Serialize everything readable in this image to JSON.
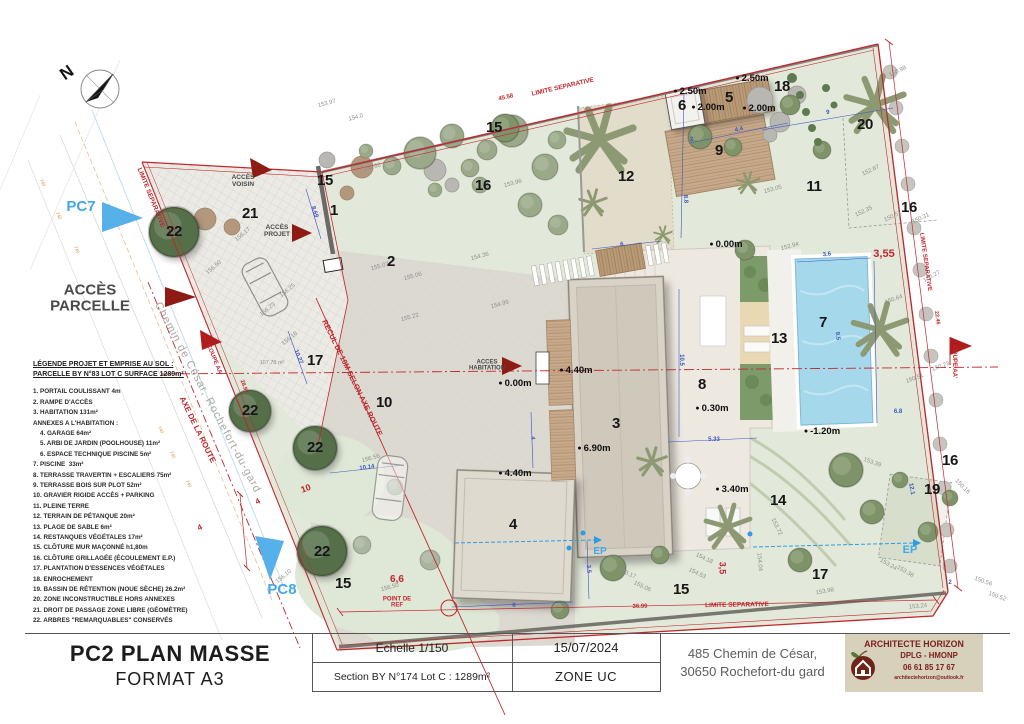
{
  "document": {
    "type_label": "PC2 PLAN MASSE",
    "format_label": "FORMAT A3"
  },
  "title_block": {
    "scale_label": "Echelle  1/150",
    "section_label": "Section BY N°174 Lot C : 1289m²",
    "date": "15/07/2024",
    "zone": "ZONE UC",
    "address_line1": "485 Chemin de César,",
    "address_line2": "30650 Rochefort-du gard",
    "architect": {
      "name": "ARCHITECTE HORIZON",
      "title": "DPLG - HMONP",
      "phone": "06 61 85 17 67",
      "email": "architectehorizon@outlook.fr"
    }
  },
  "legend": {
    "title_line1": "LÉGENDE PROJET ET EMPRISE AU SOL :",
    "title_line2": "PARCELLE BY N°83 LOT C SURFACE 1289m²",
    "items": [
      "1. PORTAIL COULISSANT 4m",
      "2. RAMPE D'ACCÈS",
      "3. HABITATION 131m²",
      "ANNEXES A L'HABITATION :",
      "    4. GARAGE 64m²",
      "    5. ARBI DE JARDIN (POOLHOUSE) 11m²",
      "    6. ESPACE TECHNIQUE PISCINE 5m²",
      "7. PISCINE  33m²",
      "8. TERRASSE TRAVERTIN + ESCALIERS 75m²",
      "9. TERRASSE BOIS SUR PLOT 52m²",
      "10. GRAVIER RIGIDE ACCÈS + PARKING",
      "11. PLEINE TERRE",
      "12. TERRAIN DE PÉTANQUE 20m²",
      "13. PLAGE DE SABLE 6m²",
      "14. RESTANQUES VÉGÉTALES 17m²",
      "15. CLÔTURE MUR MAÇONNÉ h1,80m",
      "16. CLÔTURE GRILLAGÉE (ÉCOULEMENT E.P.)",
      "17. PLANTATION D'ESSENCES VÉGÉTALES",
      "18. ENROCHEMENT",
      "19. BASSIN DE RÉTENTION (NOUE SÈCHE) 26.2m²",
      "20. ZONE INCONSTRUCTIBLE HORS ANNEXES",
      "21. DROIT DE PASSAGE ZONE LIBRE (GÉOMÈTRE)",
      "22. ARBRES \"REMARQUABLES\" CONSERVÉS"
    ]
  },
  "colors": {
    "boundary_red": "#c0272d",
    "dimension_blue": "#3d55c4",
    "marker_blue": "#45a7e8",
    "access_arrow_red": "#8e1b14",
    "pool_blue": "#a6d8ec",
    "logo_bg": "#d7d1bc",
    "logo_text": "#7a2020"
  },
  "plan": {
    "zone_numbers": [
      {
        "t": "22",
        "x": 174,
        "y": 232
      },
      {
        "t": "22",
        "x": 250,
        "y": 411
      },
      {
        "t": "22",
        "x": 315,
        "y": 448
      },
      {
        "t": "22",
        "x": 322,
        "y": 552
      },
      {
        "t": "21",
        "x": 250,
        "y": 214
      },
      {
        "t": "20",
        "x": 865,
        "y": 125
      },
      {
        "t": "18",
        "x": 782,
        "y": 87
      },
      {
        "t": "15",
        "x": 325,
        "y": 181
      },
      {
        "t": "15",
        "x": 494,
        "y": 128
      },
      {
        "t": "15",
        "x": 343,
        "y": 584
      },
      {
        "t": "15",
        "x": 681,
        "y": 590
      },
      {
        "t": "16",
        "x": 483,
        "y": 186
      },
      {
        "t": "16",
        "x": 909,
        "y": 208
      },
      {
        "t": "16",
        "x": 950,
        "y": 461
      },
      {
        "t": "1",
        "x": 334,
        "y": 211
      },
      {
        "t": "2",
        "x": 391,
        "y": 262
      },
      {
        "t": "12",
        "x": 626,
        "y": 177
      },
      {
        "t": "11",
        "x": 814,
        "y": 187
      },
      {
        "t": "5",
        "x": 729,
        "y": 98
      },
      {
        "t": "6",
        "x": 682,
        "y": 106
      },
      {
        "t": "9",
        "x": 719,
        "y": 151
      },
      {
        "t": "10",
        "x": 384,
        "y": 403
      },
      {
        "t": "17",
        "x": 315,
        "y": 361
      },
      {
        "t": "17",
        "x": 820,
        "y": 575
      },
      {
        "t": "3",
        "x": 616,
        "y": 424
      },
      {
        "t": "4",
        "x": 513,
        "y": 525
      },
      {
        "t": "8",
        "x": 702,
        "y": 385
      },
      {
        "t": "7",
        "x": 823,
        "y": 323
      },
      {
        "t": "13",
        "x": 779,
        "y": 339
      },
      {
        "t": "14",
        "x": 778,
        "y": 501
      },
      {
        "t": "19",
        "x": 932,
        "y": 490
      }
    ],
    "level_points": [
      {
        "t": "2.50m",
        "x": 690,
        "y": 92
      },
      {
        "t": "2.50m",
        "x": 752,
        "y": 79
      },
      {
        "t": "2.00m",
        "x": 708,
        "y": 108
      },
      {
        "t": "2.00m",
        "x": 759,
        "y": 109
      },
      {
        "t": "0.00m",
        "x": 726,
        "y": 245
      },
      {
        "t": "0.00m",
        "x": 515,
        "y": 384
      },
      {
        "t": "4.40m",
        "x": 576,
        "y": 371
      },
      {
        "t": "4.40m",
        "x": 515,
        "y": 474
      },
      {
        "t": "6.90m",
        "x": 594,
        "y": 449
      },
      {
        "t": "0.30m",
        "x": 712,
        "y": 409
      },
      {
        "t": "-1.20m",
        "x": 822,
        "y": 432
      },
      {
        "t": "3.40m",
        "x": 732,
        "y": 490
      }
    ],
    "red_labels": [
      {
        "t": "LIMITE SEPARATIVE",
        "x": 563,
        "y": 88,
        "rot": -13
      },
      {
        "t": "45.58",
        "x": 506,
        "y": 98,
        "rot": -13,
        "fs": 6
      },
      {
        "t": "LIMITE SEPARATIVE",
        "x": 150,
        "y": 198,
        "rot": 68
      },
      {
        "t": "LIMITE SEPARATIVE",
        "x": 925,
        "y": 262,
        "rot": 82,
        "fs": 6
      },
      {
        "t": "22.46",
        "x": 936,
        "y": 318,
        "rot": 82,
        "fs": 5.5
      },
      {
        "t": "LIMITE SEPARATIVE",
        "x": 737,
        "y": 606,
        "rot": -1
      },
      {
        "t": "36.99",
        "x": 640,
        "y": 607,
        "rot": -1,
        "fs": 6
      },
      {
        "t": "COUPE AA'",
        "x": 954,
        "y": 362,
        "rot": 90,
        "fs": 6
      },
      {
        "t": "COUPE AA'",
        "x": 214,
        "y": 360,
        "rot": 68,
        "fs": 6
      },
      {
        "t": "28.92",
        "x": 243,
        "y": 387,
        "rot": 68,
        "fs": 5.5
      },
      {
        "t": "AXE DE LA ROUTE",
        "x": 197,
        "y": 430,
        "rot": 64,
        "fs": 8
      },
      {
        "t": "RECUL DE 10M SELON AXE ROUTE",
        "x": 352,
        "y": 378,
        "rot": 64,
        "fs": 7.5
      },
      {
        "t": "POINT DE\nREF",
        "x": 397,
        "y": 603,
        "fs": 6
      },
      {
        "t": "3,55",
        "x": 884,
        "y": 255,
        "fs": 11
      },
      {
        "t": "3,5",
        "x": 722,
        "y": 568,
        "rot": 90,
        "fs": 9
      },
      {
        "t": "6,6",
        "x": 397,
        "y": 580,
        "fs": 10
      },
      {
        "t": "10",
        "x": 306,
        "y": 489,
        "rot": -20,
        "fs": 9
      },
      {
        "t": "4",
        "x": 258,
        "y": 502,
        "rot": -25,
        "fs": 8
      },
      {
        "t": "4",
        "x": 200,
        "y": 528,
        "rot": -25,
        "fs": 8
      }
    ],
    "blue_dims": [
      {
        "t": "4.4",
        "x": 739,
        "y": 130,
        "rot": -12
      },
      {
        "t": "2",
        "x": 692,
        "y": 140,
        "rot": -12
      },
      {
        "t": "9",
        "x": 828,
        "y": 113,
        "rot": -10
      },
      {
        "t": "8.8",
        "x": 685,
        "y": 199,
        "rot": 87
      },
      {
        "t": "6",
        "x": 622,
        "y": 245,
        "rot": -10
      },
      {
        "t": "3.6",
        "x": 827,
        "y": 255,
        "rot": -8
      },
      {
        "t": "9.5",
        "x": 837,
        "y": 336,
        "rot": 85
      },
      {
        "t": "10.5",
        "x": 681,
        "y": 360,
        "rot": 90
      },
      {
        "t": "5.33",
        "x": 714,
        "y": 440
      },
      {
        "t": "4",
        "x": 532,
        "y": 438,
        "rot": 87
      },
      {
        "t": "8",
        "x": 514,
        "y": 606,
        "rot": 3
      },
      {
        "t": "3.5",
        "x": 588,
        "y": 569,
        "rot": 87
      },
      {
        "t": "10.14",
        "x": 367,
        "y": 468,
        "rot": -8
      },
      {
        "t": "10.27",
        "x": 298,
        "y": 357,
        "rot": 68
      },
      {
        "t": "8.69",
        "x": 314,
        "y": 212,
        "rot": 72
      },
      {
        "t": "2",
        "x": 950,
        "y": 583
      },
      {
        "t": "6.8",
        "x": 898,
        "y": 412
      },
      {
        "t": "12.1",
        "x": 911,
        "y": 489,
        "rot": 80
      }
    ],
    "spot_elevations": [
      {
        "t": "153.97",
        "x": 327,
        "y": 104,
        "rot": -15
      },
      {
        "t": "154.0",
        "x": 356,
        "y": 118,
        "rot": -15
      },
      {
        "t": "154.68",
        "x": 372,
        "y": 168,
        "rot": -15
      },
      {
        "t": "153.96",
        "x": 513,
        "y": 184,
        "rot": -15
      },
      {
        "t": "154.36",
        "x": 480,
        "y": 257,
        "rot": -15
      },
      {
        "t": "155.07",
        "x": 380,
        "y": 267,
        "rot": -15
      },
      {
        "t": "155.06",
        "x": 413,
        "y": 277,
        "rot": -15
      },
      {
        "t": "155.22",
        "x": 410,
        "y": 318,
        "rot": -15
      },
      {
        "t": "154.99",
        "x": 500,
        "y": 305,
        "rot": -15
      },
      {
        "t": "153.05",
        "x": 773,
        "y": 190,
        "rot": -15
      },
      {
        "t": "152.94",
        "x": 790,
        "y": 247,
        "rot": -15
      },
      {
        "t": "152.67",
        "x": 871,
        "y": 171,
        "rot": -25
      },
      {
        "t": "152.35",
        "x": 864,
        "y": 212,
        "rot": -25
      },
      {
        "t": "150.51",
        "x": 893,
        "y": 217,
        "rot": -25
      },
      {
        "t": "150.31",
        "x": 921,
        "y": 219,
        "rot": -25
      },
      {
        "t": "150.98",
        "x": 898,
        "y": 72,
        "rot": -25
      },
      {
        "t": "150.27",
        "x": 932,
        "y": 277,
        "rot": -30
      },
      {
        "t": "150.64",
        "x": 894,
        "y": 300,
        "rot": -20
      },
      {
        "t": "150.23",
        "x": 941,
        "y": 367,
        "rot": -20
      },
      {
        "t": "150.51",
        "x": 915,
        "y": 379,
        "rot": -20
      },
      {
        "t": "150.16",
        "x": 962,
        "y": 487,
        "rot": 45
      },
      {
        "t": "150.56",
        "x": 983,
        "y": 582,
        "rot": 20
      },
      {
        "t": "150.52",
        "x": 997,
        "y": 597,
        "rot": 20
      },
      {
        "t": "153.24",
        "x": 918,
        "y": 607,
        "rot": -5
      },
      {
        "t": "153.24",
        "x": 888,
        "y": 565,
        "rot": 30
      },
      {
        "t": "153.38",
        "x": 905,
        "y": 572,
        "rot": 30
      },
      {
        "t": "153.39",
        "x": 872,
        "y": 463,
        "rot": 20
      },
      {
        "t": "153.98",
        "x": 825,
        "y": 592,
        "rot": -10
      },
      {
        "t": "153.72",
        "x": 776,
        "y": 527,
        "rot": 65
      },
      {
        "t": "154.18",
        "x": 704,
        "y": 559,
        "rot": 25
      },
      {
        "t": "154.53",
        "x": 697,
        "y": 574,
        "rot": 25
      },
      {
        "t": "154.04",
        "x": 759,
        "y": 562,
        "rot": 85
      },
      {
        "t": "153.17",
        "x": 627,
        "y": 574,
        "rot": 25
      },
      {
        "t": "155.06",
        "x": 642,
        "y": 587,
        "rot": 25
      },
      {
        "t": "156.56",
        "x": 371,
        "y": 459,
        "rot": -15
      },
      {
        "t": "156.50",
        "x": 214,
        "y": 268,
        "rot": -40
      },
      {
        "t": "156.25",
        "x": 288,
        "y": 291,
        "rot": -40
      },
      {
        "t": "156.23",
        "x": 268,
        "y": 310,
        "rot": -40
      },
      {
        "t": "156.18",
        "x": 290,
        "y": 339,
        "rot": -40
      },
      {
        "t": "156.17",
        "x": 243,
        "y": 235,
        "rot": -40
      },
      {
        "t": "156.50",
        "x": 390,
        "y": 588,
        "rot": -15
      },
      {
        "t": "156.10",
        "x": 284,
        "y": 577,
        "rot": -40
      },
      {
        "t": "107.78 m²",
        "x": 272,
        "y": 364,
        "fs": 5.5
      }
    ],
    "contour_labels": [
      {
        "t": "740",
        "x": 42,
        "y": 183,
        "rot": 65
      },
      {
        "t": "740",
        "x": 58,
        "y": 216,
        "rot": 65
      },
      {
        "t": "740",
        "x": 76,
        "y": 250,
        "rot": 65
      },
      {
        "t": "740",
        "x": 160,
        "y": 430,
        "rot": 65
      },
      {
        "t": "740",
        "x": 172,
        "y": 455,
        "rot": 65
      },
      {
        "t": "740",
        "x": 188,
        "y": 484,
        "rot": 65
      }
    ],
    "access_labels": [
      {
        "t": "ACCÈS\nPARCELLE",
        "x": 90,
        "y": 298,
        "fs": 15
      },
      {
        "t": "ACCÈS\nVOISIN",
        "x": 243,
        "y": 182
      },
      {
        "t": "ACCÈS\nPROJET",
        "x": 277,
        "y": 232
      },
      {
        "t": "ACCES\nHABITATION",
        "x": 487,
        "y": 366,
        "fs": 6
      }
    ],
    "marker_labels": [
      {
        "t": "PC7",
        "x": 81,
        "y": 207,
        "fs": 15
      },
      {
        "t": "PC8",
        "x": 282,
        "y": 590,
        "fs": 15
      },
      {
        "t": "EP",
        "x": 600,
        "y": 552,
        "fs": 10
      },
      {
        "t": "EP",
        "x": 910,
        "y": 551,
        "fs": 11
      },
      {
        "t": "N",
        "x": 67,
        "y": 73,
        "fs": 17,
        "rot": -35,
        "c": "#141414"
      }
    ],
    "street_labels": [
      {
        "t": "Chemin de César, Rochefort-du-gard",
        "x": 207,
        "y": 398,
        "rot": 62
      }
    ]
  }
}
